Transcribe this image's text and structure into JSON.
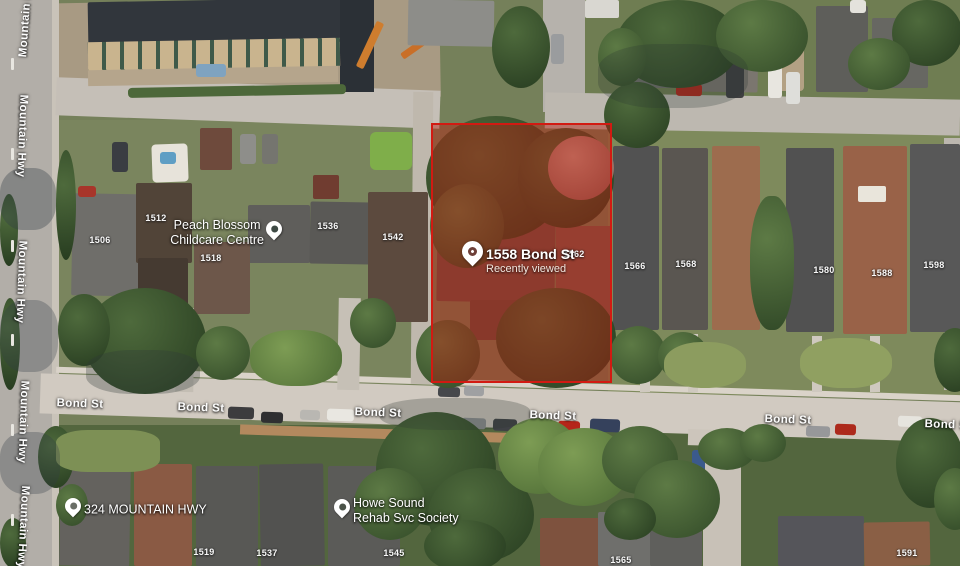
{
  "selected_place": {
    "name": "1558 Bond St",
    "status": "Recently viewed",
    "x": 473,
    "y": 258
  },
  "boundary": {
    "stroke": "#d21a12",
    "fill": "rgba(185,24,12,0.44)"
  },
  "streets": {
    "vertical": {
      "name": "Mountain Hwy",
      "instances": [
        {
          "x": 26,
          "y": 16,
          "r": -86
        },
        {
          "x": 22,
          "y": 136,
          "r": 92
        },
        {
          "x": 21,
          "y": 282,
          "r": 92
        },
        {
          "x": 23,
          "y": 422,
          "r": 92
        },
        {
          "x": 23,
          "y": 527,
          "r": 93
        }
      ]
    },
    "horizontal": {
      "name": "Bond St",
      "instances": [
        {
          "x": 80,
          "y": 404,
          "r": 2
        },
        {
          "x": 201,
          "y": 408,
          "r": 2
        },
        {
          "x": 378,
          "y": 413,
          "r": 2
        },
        {
          "x": 553,
          "y": 416,
          "r": 2
        },
        {
          "x": 788,
          "y": 420,
          "r": 2
        },
        {
          "x": 948,
          "y": 425,
          "r": 2
        }
      ]
    }
  },
  "house_numbers": [
    {
      "number": "1506",
      "x": 100,
      "y": 240
    },
    {
      "number": "1512",
      "x": 156,
      "y": 218
    },
    {
      "number": "1518",
      "x": 211,
      "y": 258
    },
    {
      "number": "1536",
      "x": 328,
      "y": 226
    },
    {
      "number": "1542",
      "x": 393,
      "y": 237
    },
    {
      "number": "1562",
      "x": 574,
      "y": 254
    },
    {
      "number": "1566",
      "x": 635,
      "y": 266
    },
    {
      "number": "1568",
      "x": 686,
      "y": 264
    },
    {
      "number": "1580",
      "x": 824,
      "y": 270
    },
    {
      "number": "1588",
      "x": 882,
      "y": 273
    },
    {
      "number": "1598",
      "x": 934,
      "y": 265
    },
    {
      "number": "1519",
      "x": 204,
      "y": 552
    },
    {
      "number": "1537",
      "x": 267,
      "y": 553
    },
    {
      "number": "1545",
      "x": 394,
      "y": 553
    },
    {
      "number": "1565",
      "x": 621,
      "y": 560
    },
    {
      "number": "1591",
      "x": 907,
      "y": 553
    }
  ],
  "pois": [
    {
      "name": "Peach Blossom Childcare Centre",
      "lines": [
        "Peach Blossom",
        "Childcare Centre"
      ],
      "x": 274,
      "y": 233,
      "text_side": "left",
      "pin_hole_color": "#3e4a44"
    },
    {
      "name": "324 Mountain Hwy",
      "lines": [
        "324 MOUNTAIN HWY"
      ],
      "x": 73,
      "y": 510,
      "text_side": "right",
      "pin_hole_color": "#6a6e66"
    },
    {
      "name": "Howe Sound Rehab Svc Society",
      "lines": [
        "Howe Sound",
        "Rehab Svc Society"
      ],
      "x": 342,
      "y": 511,
      "text_side": "right",
      "pin_hole_color": "#4a5248"
    }
  ]
}
